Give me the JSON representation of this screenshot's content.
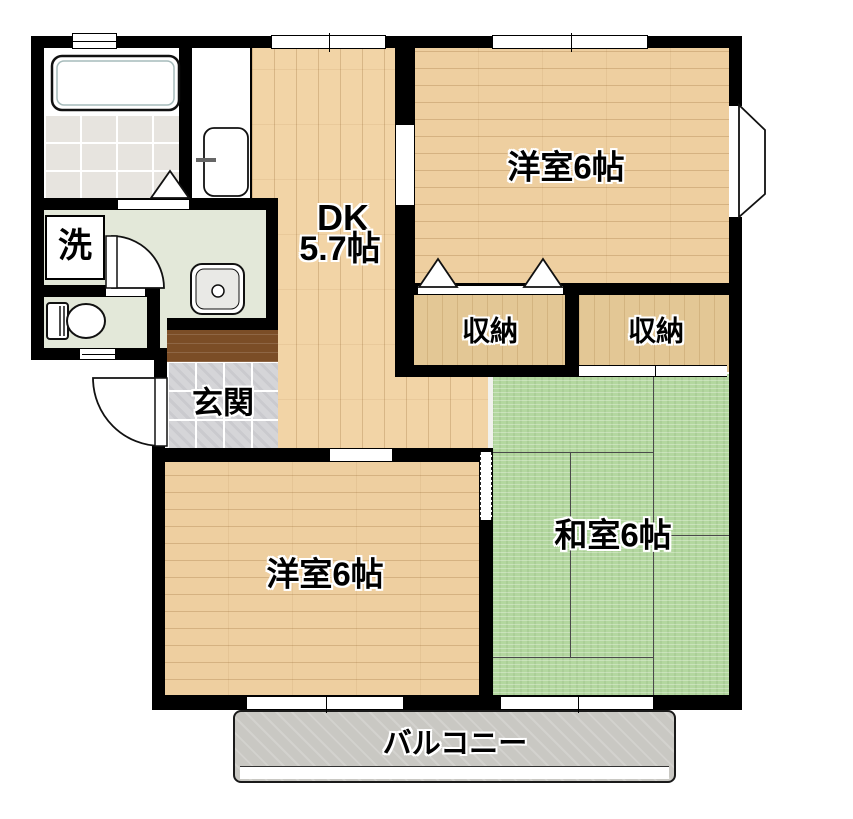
{
  "floorplan": {
    "type": "2DK apartment floor plan",
    "labels": {
      "dk_line1": "DK",
      "dk_line2": "5.7帖",
      "yoshitsu_top": "洋室6帖",
      "yoshitsu_bottom": "洋室6帖",
      "washitsu": "和室6帖",
      "closet_left": "収納",
      "closet_right": "収納",
      "genkan": "玄関",
      "laundry": "洗",
      "balcony": "バルコニー"
    },
    "colors": {
      "wall": "#000000",
      "dk_wood": "#f2d4a6",
      "room_wood": "#eecfa0",
      "closet_wood": "#e3c795",
      "tatami_green": "#b3d79f",
      "washroom_green": "#e3e8d9",
      "bath_tile": "#e7e4df",
      "bathtub_cyan": "#7cf1ee",
      "genkan_tile": "#d5d5d8",
      "kamachi_brown": "#7b4d26",
      "balcony_gray": "#c9c8c3"
    }
  }
}
